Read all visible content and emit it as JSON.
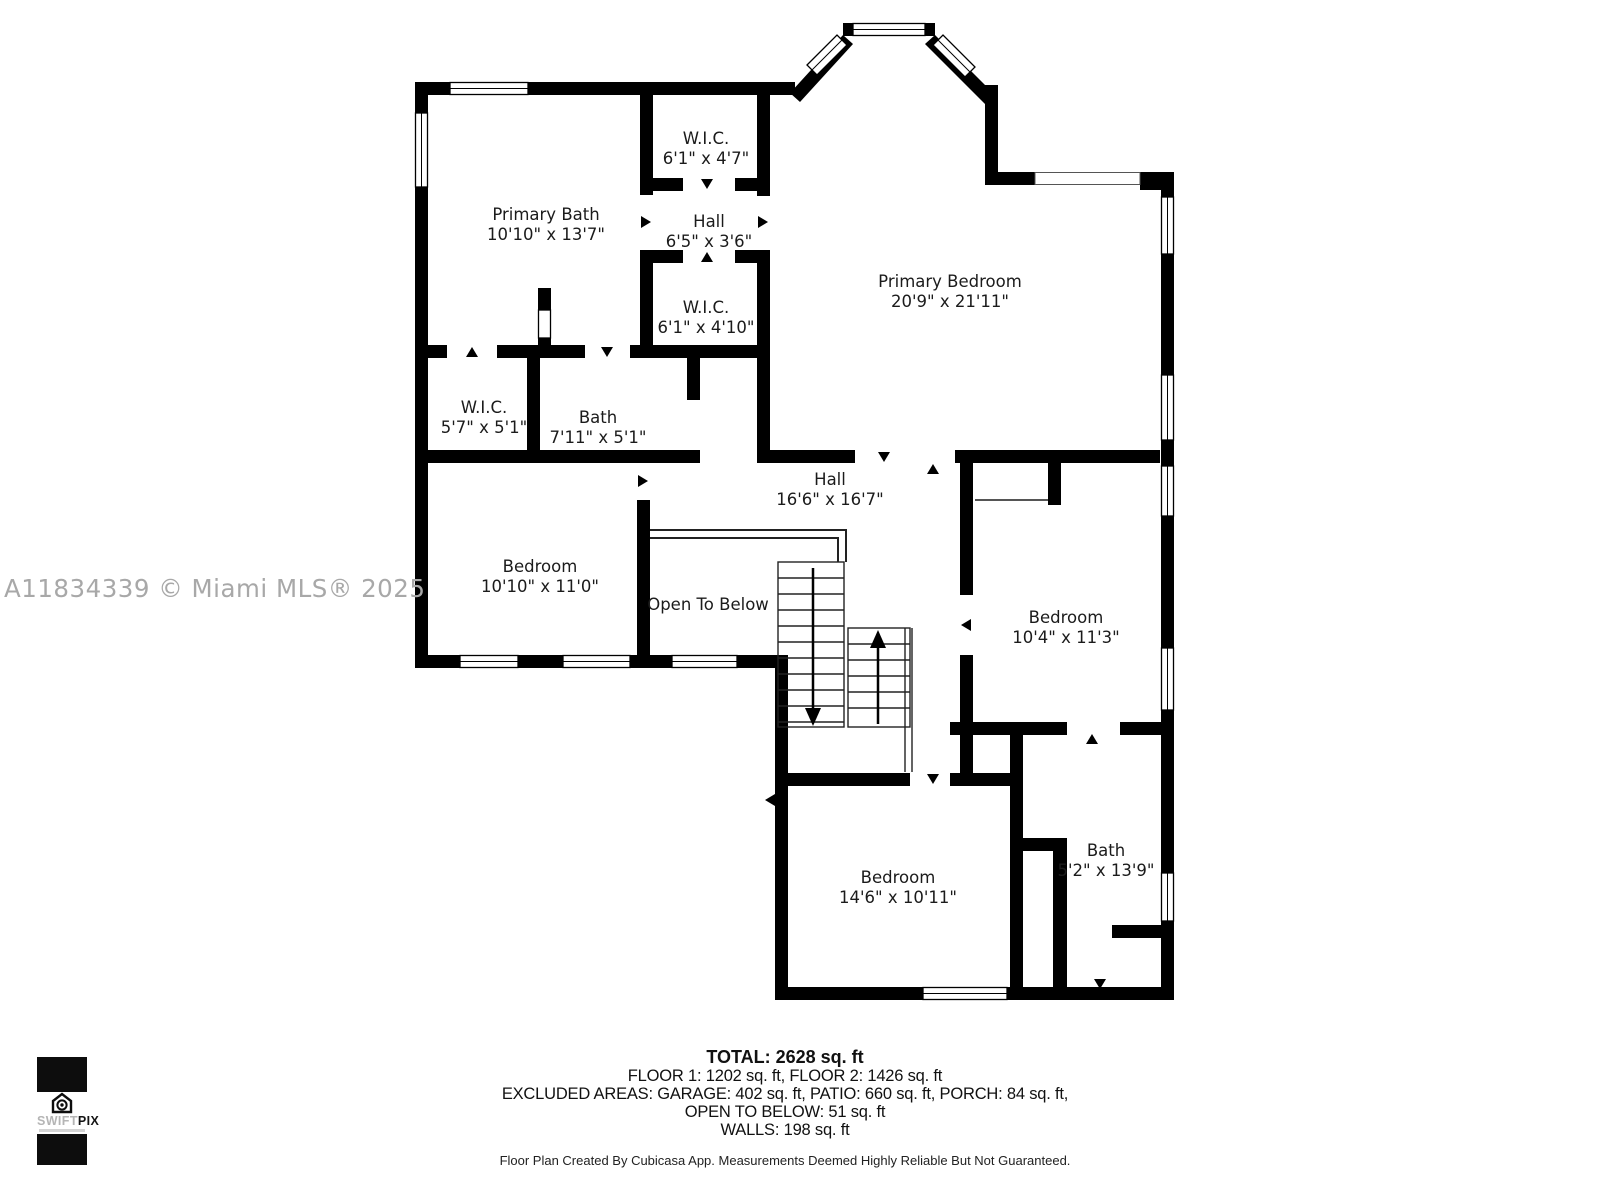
{
  "watermark": "A11834339 © Miami MLS® 2025",
  "rooms": [
    {
      "name": "Primary Bath",
      "dims": "10'10\" x 13'7\""
    },
    {
      "name": "W.I.C.",
      "dims": "6'1\" x 4'7\""
    },
    {
      "name": "Hall",
      "dims": "6'5\" x 3'6\""
    },
    {
      "name": "W.I.C.",
      "dims": "6'1\" x 4'10\""
    },
    {
      "name": "Primary Bedroom",
      "dims": "20'9\" x 21'11\""
    },
    {
      "name": "W.I.C.",
      "dims": "5'7\" x 5'1\""
    },
    {
      "name": "Bath",
      "dims": "7'11\" x 5'1\""
    },
    {
      "name": "Bedroom",
      "dims": "10'10\" x 11'0\""
    },
    {
      "name": "Hall",
      "dims": "16'6\" x 16'7\""
    },
    {
      "name": "Open To Below",
      "dims": ""
    },
    {
      "name": "Bedroom",
      "dims": "10'4\" x 11'3\""
    },
    {
      "name": "Bedroom",
      "dims": "14'6\" x 10'11\""
    },
    {
      "name": "Bath",
      "dims": "5'2\" x 13'9\""
    }
  ],
  "summary": {
    "total": "TOTAL: 2628 sq. ft",
    "floors": "FLOOR 1: 1202 sq. ft, FLOOR 2: 1426 sq. ft",
    "excluded": "EXCLUDED AREAS: GARAGE: 402 sq. ft, PATIO: 660 sq. ft, PORCH: 84 sq. ft,",
    "open_below": "OPEN TO BELOW: 51 sq. ft",
    "walls": "WALLS: 198 sq. ft"
  },
  "footer": "Floor Plan Created By Cubicasa App. Measurements Deemed Highly Reliable But Not Guaranteed.",
  "logo": {
    "swift": "SWIFT",
    "pix": "PIX"
  }
}
